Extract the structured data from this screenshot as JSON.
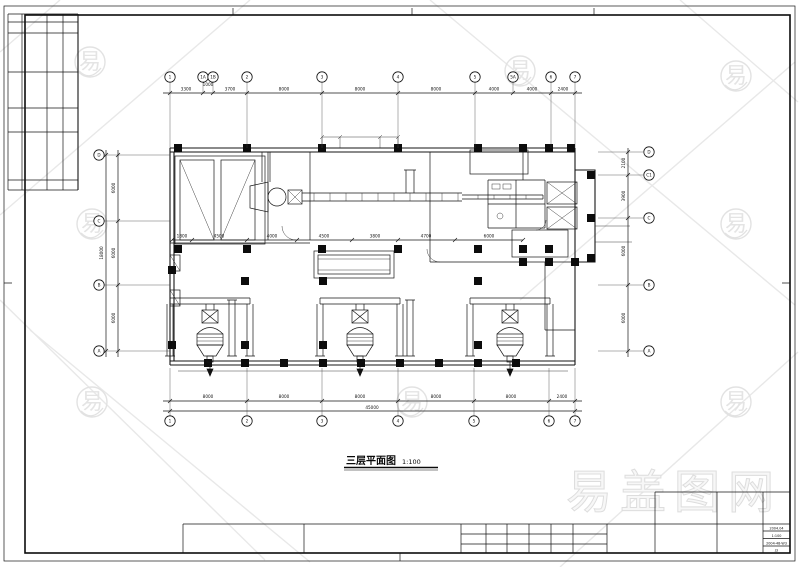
{
  "sheet": {
    "plan_title": "三层平面图",
    "plan_scale": "1:100"
  },
  "grid": {
    "top": {
      "bubbles": [
        "1",
        "1A",
        "1B",
        "2",
        "3",
        "4",
        "5",
        "5A",
        "6",
        "7"
      ],
      "dims": [
        "3300",
        "1000",
        "3700",
        "8000",
        "8000",
        "8000",
        "4000",
        "4000",
        "2400"
      ]
    },
    "bottom": {
      "bubbles": [
        "1",
        "2",
        "3",
        "4",
        "5",
        "6",
        "7"
      ],
      "dims": [
        "8000",
        "8000",
        "8000",
        "8000",
        "8000",
        "2400"
      ],
      "overall": "45000"
    },
    "left": {
      "bubbles": [
        "D",
        "C",
        "B",
        "A"
      ],
      "dims": [
        "6000",
        "6000",
        "6000"
      ],
      "overall": "18000"
    },
    "right": {
      "bubbles": [
        "D",
        "C1",
        "C",
        "B",
        "A"
      ],
      "dims": [
        "2100",
        "3900",
        "6000",
        "6000"
      ]
    }
  },
  "interior_dims": [
    "1800",
    "4500",
    "4000",
    "4500",
    "3800",
    "4700",
    "6000"
  ],
  "title_block": {
    "date": "2004.04",
    "scale": "1:100",
    "drawing_no": "2004-48-W3",
    "sheet_no": "J3"
  },
  "watermark": {
    "glyph": "易",
    "brand": "易盖图网"
  }
}
